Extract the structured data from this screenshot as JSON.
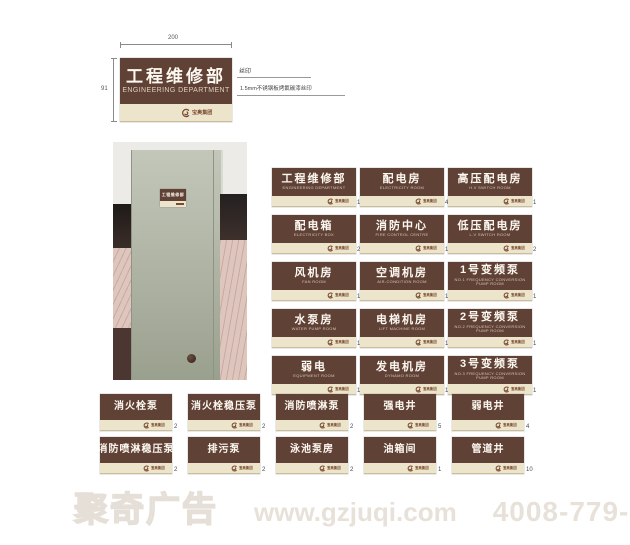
{
  "brand": {
    "icon": "swirl-logo",
    "text": "宝奥集团"
  },
  "spec": {
    "width_label": "200",
    "height_label": "91",
    "callout_top": "丝印",
    "callout_bottom": "1.5mm不锈钢板烤氟碳漆丝印",
    "sign": {
      "cn": "工程维修部",
      "en": "ENGINEERING DEPARTMENT"
    }
  },
  "photo": {
    "door_sign_cn": "工程维修部"
  },
  "main_signs": [
    {
      "cn": "工程维修部",
      "en": "ENGINEERING DEPARTMENT",
      "qty": "1"
    },
    {
      "cn": "配电箱",
      "en": "ELECTRICITY BOX",
      "qty": "20"
    },
    {
      "cn": "风机房",
      "en": "FAN ROOM",
      "qty": "1"
    },
    {
      "cn": "水泵房",
      "en": "WATER PUMP ROOM",
      "qty": "1"
    },
    {
      "cn": "弱电",
      "en": "EQUIPMENT ROOM",
      "qty": "1"
    },
    {
      "cn": "配电房",
      "en": "ELECTRICITY ROOM",
      "qty": "4"
    },
    {
      "cn": "消防中心",
      "en": "FIRE CONTROL CENTRE",
      "qty": "1"
    },
    {
      "cn": "空调机房",
      "en": "AIR-CONDITION ROOM",
      "qty": "1"
    },
    {
      "cn": "电梯机房",
      "en": "LIFT MACHINE ROOM",
      "qty": "1"
    },
    {
      "cn": "发电机房",
      "en": "DYNAMO ROOM",
      "qty": "1"
    },
    {
      "cn": "高压配电房",
      "en": "H.V SWITCH ROOM",
      "qty": "1"
    },
    {
      "cn": "低压配电房",
      "en": "L.V SWITCH ROOM",
      "qty": "2"
    },
    {
      "cn": "1号变频泵",
      "en": "NO.1 FREQUENCY CONVERSION PUMP ROOM",
      "qty": "1"
    },
    {
      "cn": "2号变频泵",
      "en": "NO.2 FREQUENCY CONVERSION PUMP ROOM",
      "qty": "1"
    },
    {
      "cn": "3号变频泵",
      "en": "NO.3 FREQUENCY CONVERSION PUMP ROOM",
      "qty": "1"
    }
  ],
  "small_signs": [
    {
      "cn": "消火栓泵",
      "qty": "2"
    },
    {
      "cn": "消火栓稳压泵",
      "qty": "2"
    },
    {
      "cn": "消防喷淋泵",
      "qty": "2"
    },
    {
      "cn": "强电井",
      "qty": "5"
    },
    {
      "cn": "弱电井",
      "qty": "4"
    },
    {
      "cn": "消防喷淋稳压泵",
      "qty": "2"
    },
    {
      "cn": "排污泵",
      "qty": "2"
    },
    {
      "cn": "泳池泵房",
      "qty": "2"
    },
    {
      "cn": "油箱间",
      "qty": "1"
    },
    {
      "cn": "管道井",
      "qty": "10"
    }
  ],
  "watermark": {
    "brand": "聚奇广告",
    "url": "www.gzjuqi.com",
    "phone": "4008-779-020"
  }
}
